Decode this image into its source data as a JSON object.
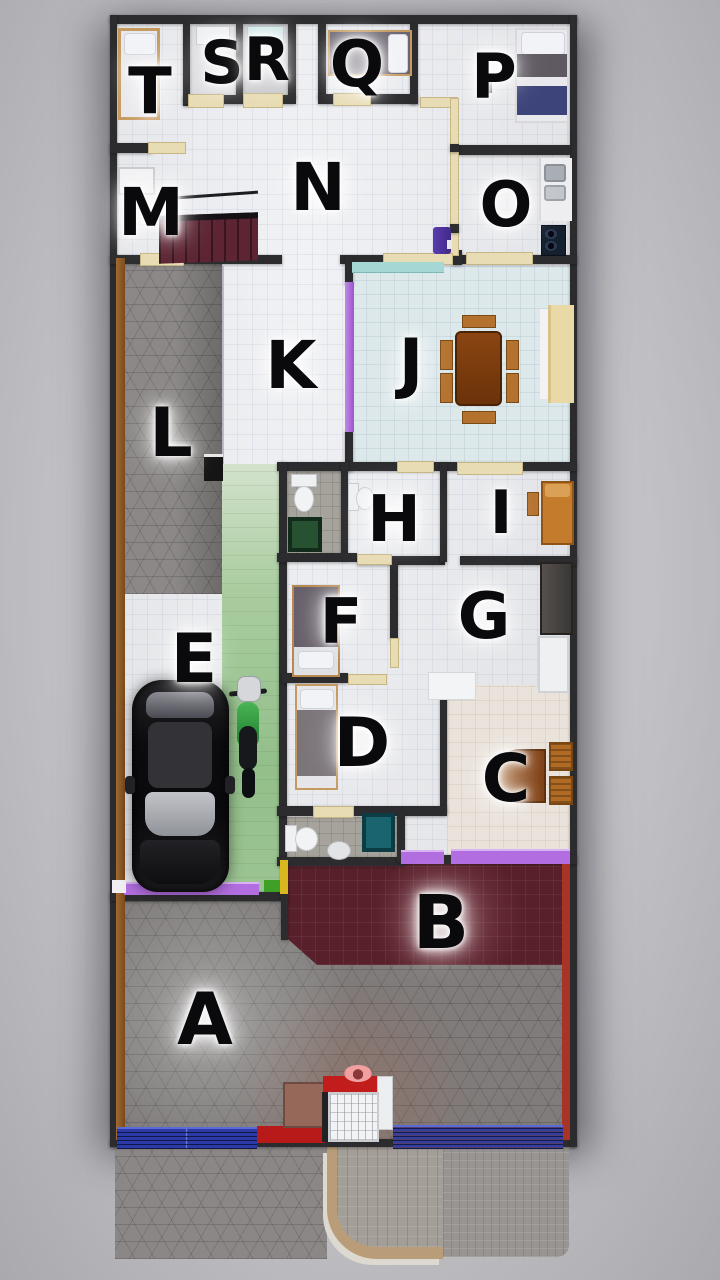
{
  "plan_type": "house-floor-plan-top-view",
  "rooms": [
    {
      "id": "T",
      "label": "T",
      "x": 150,
      "y": 92,
      "size": 64,
      "features": [
        "bed"
      ]
    },
    {
      "id": "S",
      "label": "S",
      "x": 222,
      "y": 63,
      "size": 60,
      "features": [
        "shower-tray"
      ]
    },
    {
      "id": "R",
      "label": "R",
      "x": 267,
      "y": 60,
      "size": 60,
      "features": [
        "shower-tray"
      ]
    },
    {
      "id": "Q",
      "label": "Q",
      "x": 357,
      "y": 65,
      "size": 64,
      "features": [
        "bed"
      ]
    },
    {
      "id": "P",
      "label": "P",
      "x": 494,
      "y": 77,
      "size": 62,
      "features": [
        "bed"
      ]
    },
    {
      "id": "M",
      "label": "M",
      "x": 151,
      "y": 213,
      "size": 66,
      "features": [
        "staircase",
        "closet"
      ]
    },
    {
      "id": "N",
      "label": "N",
      "x": 318,
      "y": 188,
      "size": 66,
      "features": [
        "refrigerator"
      ]
    },
    {
      "id": "O",
      "label": "O",
      "x": 506,
      "y": 205,
      "size": 62,
      "features": [
        "kitchen-sink",
        "stove"
      ]
    },
    {
      "id": "L",
      "label": "L",
      "x": 171,
      "y": 434,
      "size": 68,
      "features": [
        "stone-pavers"
      ]
    },
    {
      "id": "K",
      "label": "K",
      "x": 291,
      "y": 366,
      "size": 66,
      "features": [
        "purple-accent-wall"
      ]
    },
    {
      "id": "J",
      "label": "J",
      "x": 411,
      "y": 364,
      "size": 66,
      "features": [
        "dining-table",
        "chairs",
        "sideboard"
      ]
    },
    {
      "id": "H",
      "label": "H",
      "x": 394,
      "y": 520,
      "size": 64,
      "features": [
        "toilet"
      ]
    },
    {
      "id": "I",
      "label": "I",
      "x": 501,
      "y": 513,
      "size": 60,
      "features": [
        "single-bed",
        "side-table"
      ]
    },
    {
      "id": "E",
      "label": "E",
      "x": 194,
      "y": 660,
      "size": 68,
      "features": [
        "car",
        "scooter"
      ]
    },
    {
      "id": "F",
      "label": "F",
      "x": 341,
      "y": 622,
      "size": 62,
      "features": [
        "bed"
      ]
    },
    {
      "id": "G",
      "label": "G",
      "x": 484,
      "y": 617,
      "size": 64,
      "features": [
        "wardrobe",
        "cabinet",
        "desk"
      ]
    },
    {
      "id": "D",
      "label": "D",
      "x": 362,
      "y": 744,
      "size": 68,
      "features": [
        "bed"
      ]
    },
    {
      "id": "C",
      "label": "C",
      "x": 506,
      "y": 779,
      "size": 66,
      "features": [
        "table",
        "two-chairs"
      ]
    },
    {
      "id": "B",
      "label": "B",
      "x": 441,
      "y": 923,
      "size": 74,
      "features": [
        "maroon-tile-terrace"
      ]
    },
    {
      "id": "A",
      "label": "A",
      "x": 205,
      "y": 1019,
      "size": 72,
      "features": [
        "paved-front-yard",
        "entrance-gate"
      ]
    }
  ],
  "colors": {
    "wall": "#2c2c2f",
    "floor": "#e6e7ea",
    "dining_floor": "#dde8eb",
    "pavers": "#848180",
    "terrace": "#58202a",
    "accent_purple": "#b26ee0",
    "accent_teal": "#a5d8d4",
    "carport_green": "#9cc493",
    "stairs": "#5d2534",
    "fence_blue": "#2b3aa6",
    "gate_red": "#c21d1d",
    "wood": "#c59a5f",
    "basin_green": "#265231",
    "basin_teal": "#19646e"
  }
}
